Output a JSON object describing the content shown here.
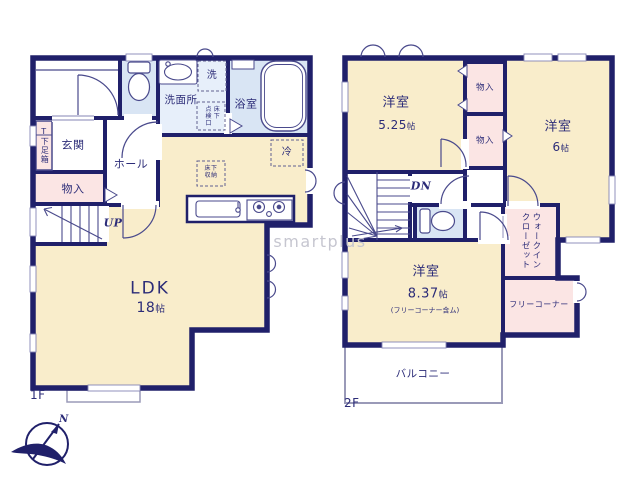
{
  "watermark": "smartplus",
  "compass": {
    "north_label": "N"
  },
  "colors": {
    "wall": "#20206a",
    "room_cream": "#f9edcb",
    "storage_pink": "#fbe5e4",
    "wet_blue": "#d9e5f4",
    "text_navy": "#2c2c78",
    "watermark_gray": "#c6c6d0"
  },
  "floor1": {
    "floor_label": "1F",
    "rooms": {
      "genkan": "玄関",
      "hall": "ホール",
      "shoe_box_t": "T",
      "shoe_box": "下足箱",
      "storage": "物入",
      "stairs_up": "UP",
      "washroom": "洗面所",
      "washer": "洗",
      "inspection_left": "点検口",
      "inspection_right": "床下",
      "bathroom": "浴室",
      "fridge": "冷",
      "underfloor_line1": "床下",
      "underfloor_line2": "収納",
      "ldk": "LDK",
      "ldk_size_num": "18",
      "ldk_size_unit": "帖"
    }
  },
  "floor2": {
    "floor_label": "2F",
    "rooms": {
      "bedroom1": "洋室",
      "bedroom1_size_num": "5.25",
      "bedroom1_size_unit": "帖",
      "closet1": "物入",
      "closet2": "物入",
      "bedroom2": "洋室",
      "bedroom2_size_num": "6",
      "bedroom2_size_unit": "帖",
      "stairs_down": "DN",
      "bedroom3": "洋室",
      "bedroom3_size_num": "8.37",
      "bedroom3_size_unit": "帖",
      "bedroom3_note": "(フリーコーナー含ム)",
      "wic_line1": "ウォークイン",
      "wic_line2": "クローゼット",
      "free_corner": "フリーコーナー",
      "balcony": "バルコニー"
    }
  }
}
